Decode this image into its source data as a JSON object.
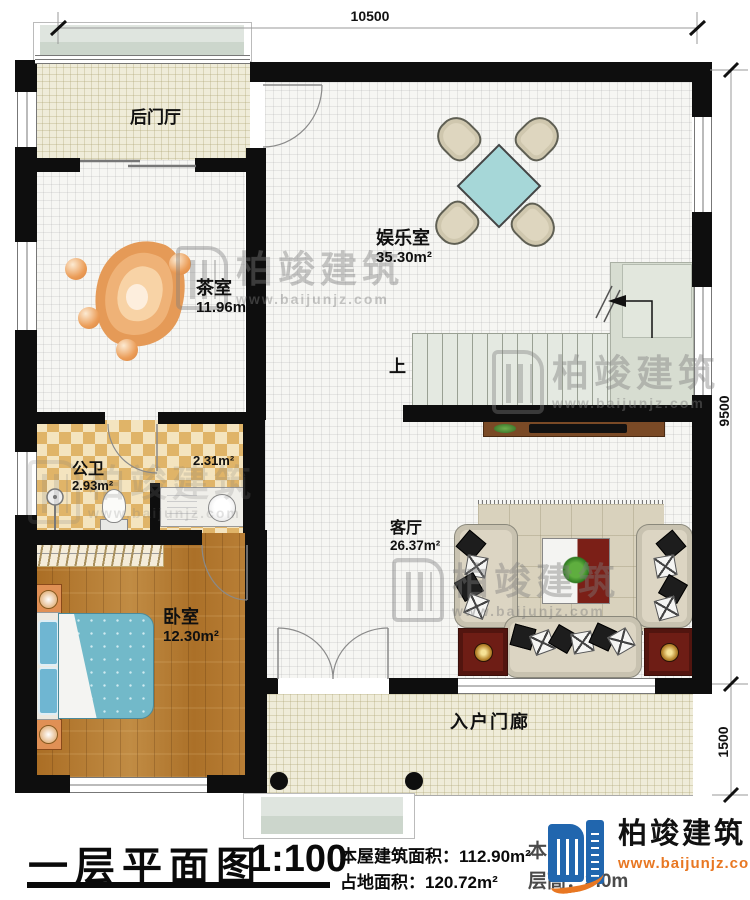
{
  "dimensions": {
    "top": "10500",
    "right_upper": "9500",
    "right_lower": "1500"
  },
  "rooms": [
    {
      "name": "后门厅",
      "area": ""
    },
    {
      "name": "娱乐室",
      "area": "35.30m²"
    },
    {
      "name": "茶室",
      "area": "11.96m²"
    },
    {
      "name": "公卫",
      "area": "2.93m²"
    },
    {
      "name": "",
      "area": "2.31m²"
    },
    {
      "name": "卧室",
      "area": "12.30m²"
    },
    {
      "name": "客厅",
      "area": "26.37m²"
    },
    {
      "name": "入户门廊",
      "area": ""
    }
  ],
  "stairs": {
    "up_label": "上"
  },
  "watermark": {
    "brand": "柏竣建筑",
    "url": "www.baijunjz.com"
  },
  "footer": {
    "title": "一层平面图",
    "scale": "1:100",
    "line1_label": "本屋建筑面积：",
    "line1_value": "112.90m²",
    "line2_label": "占地面积：",
    "line2_value": "120.72m²",
    "partial_line1": "本",
    "partial_line2": "层高：3.0m",
    "logo_brand": "柏竣建筑",
    "logo_url": "www.baijunjz.com"
  }
}
